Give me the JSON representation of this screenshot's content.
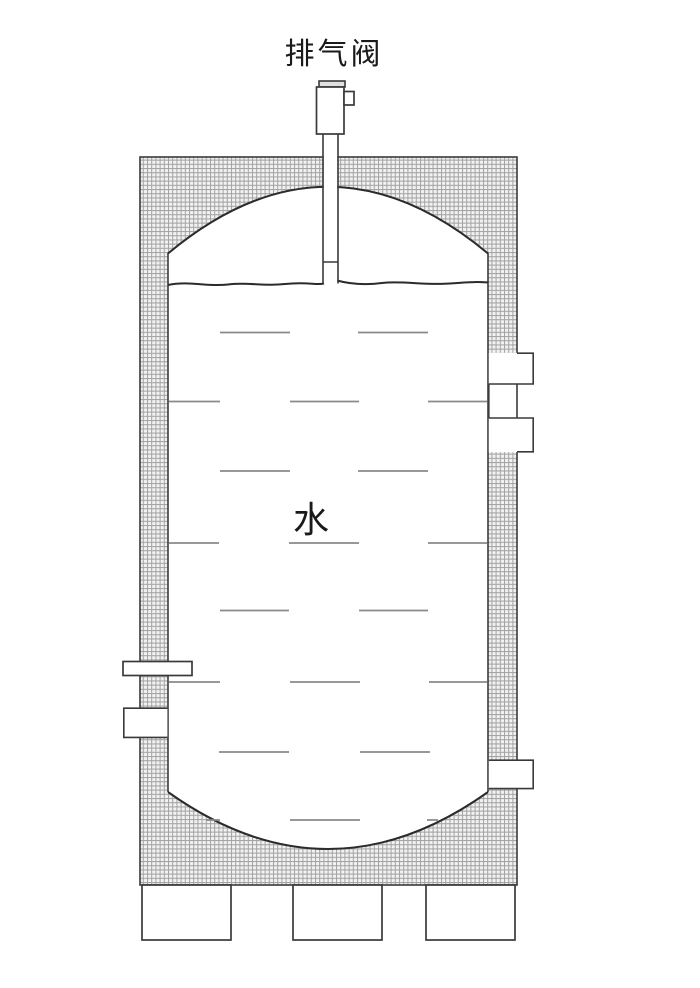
{
  "diagram": {
    "title": "排气阀",
    "tank_label": "水",
    "colors": {
      "background": "#ffffff",
      "line": "#3a3a3a",
      "arc_line": "#2b2b2b",
      "hatch_line": "#a3a3a3",
      "hatch_bg": "#f2f2f2",
      "ripple": "#8a8a8a",
      "text": "#1a1a1a"
    }
  }
}
